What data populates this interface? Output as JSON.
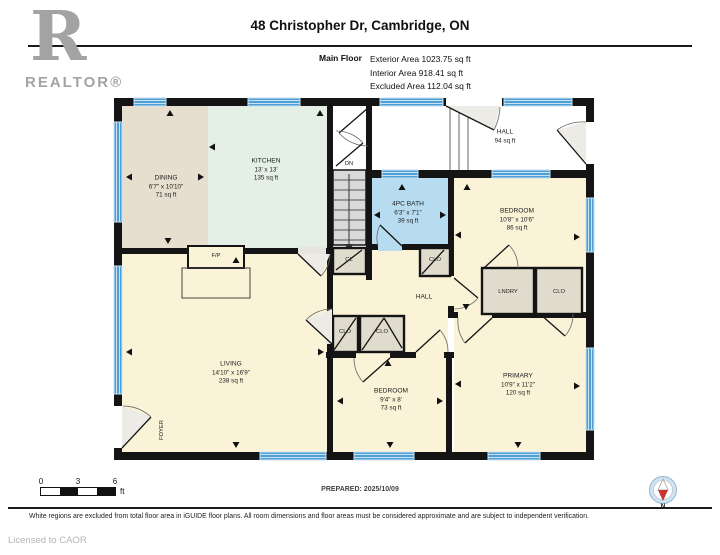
{
  "header": {
    "title": "48 Christopher Dr, Cambridge, ON",
    "floor_label": "Main Floor",
    "stats": [
      "Exterior Area 1023.75 sq ft",
      "Interior Area 918.41 sq ft",
      "Excluded Area 112.04 sq ft"
    ]
  },
  "logo": {
    "letter": "R",
    "label": "REALTOR®"
  },
  "plan": {
    "rooms": {
      "dining": {
        "name": "DINING",
        "dims": "6'7\" x 10'10\"",
        "area": "71 sq ft"
      },
      "kitchen": {
        "name": "KITCHEN",
        "dims": "13' x 13'",
        "area": "135 sq ft"
      },
      "hall_upper": {
        "name": "HALL",
        "area": "94 sq ft"
      },
      "bath": {
        "name": "4PC BATH",
        "dims": "6'3\" x 7'1\"",
        "area": "39 sq ft"
      },
      "bedroom_right": {
        "name": "BEDROOM",
        "dims": "10'8\" x 10'6\"",
        "area": "86 sq ft"
      },
      "laundry": {
        "name": "LNDRY"
      },
      "closet_right": {
        "name": "CLO"
      },
      "closet_top": {
        "name": "CLO"
      },
      "closet_small": {
        "name": "CL"
      },
      "hall_center": {
        "name": "HALL"
      },
      "closet_a": {
        "name": "CLO"
      },
      "closet_b": {
        "name": "CLO"
      },
      "living": {
        "name": "LIVING",
        "dims": "14'10\" x 16'9\"",
        "area": "238 sq ft"
      },
      "bedroom_bottom": {
        "name": "BEDROOM",
        "dims": "9'4\" x 8'",
        "area": "73 sq ft"
      },
      "primary": {
        "name": "PRIMARY",
        "dims": "10'9\" x 11'2\"",
        "area": "120 sq ft"
      },
      "foyer": {
        "name": "FOYER"
      },
      "fireplace": {
        "name": "F/P"
      },
      "stairs": {
        "name": "DN"
      }
    }
  },
  "scale_bar": {
    "ticks": [
      "0",
      "3",
      "6"
    ],
    "unit": "ft"
  },
  "footer": {
    "prepared": "PREPARED: 2025/10/09",
    "disclaimer": "White regions are excluded from total floor area in iGUIDE floor plans. All room dimensions and floor areas must be considered approximate and are subject to independent verification.",
    "license": "Licensed to CAOR",
    "compass_label": "N"
  },
  "colors": {
    "wall": "#141414",
    "window": "#4f9ed4",
    "window_light": "#c9e3f4",
    "dining": "#e6decf",
    "kitchen": "#e4efe5",
    "bath": "#b7dcf0",
    "room_yellow": "#faf3d8",
    "closet": "#e0dccd",
    "stairs": "#d9d9d9",
    "excluded": "#ffffff",
    "compass_red": "#c8342e",
    "logo_gray": "#a3a3a3"
  }
}
